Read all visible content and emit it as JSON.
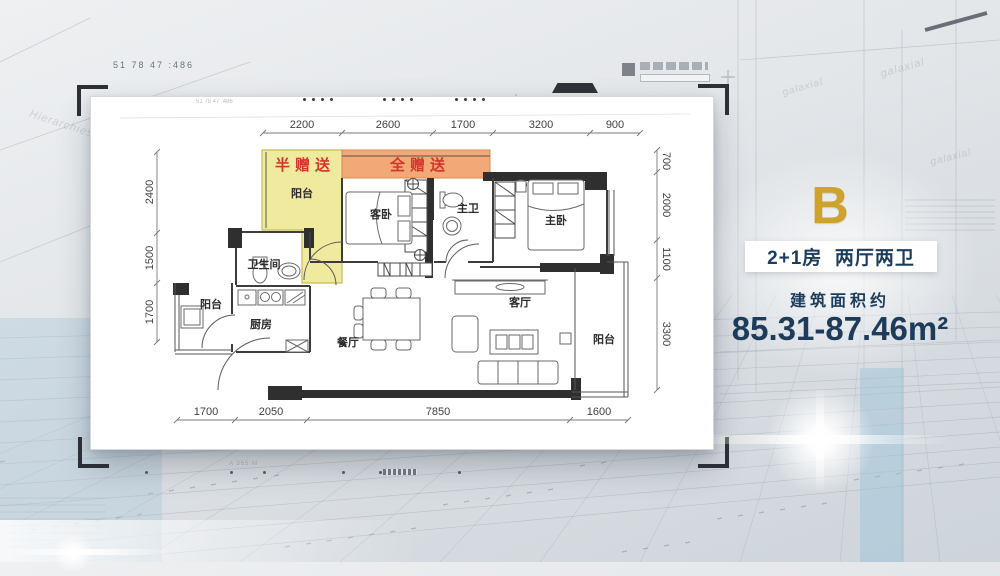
{
  "panel": {
    "block_letter": "B",
    "title": "2+1房  两厅两卫",
    "area_label": "建筑面积约",
    "area_value": "85.31-87.46m²"
  },
  "plan": {
    "gifts": {
      "half": "半赠送",
      "full": "全赠送"
    },
    "rooms": {
      "balcony_top": "阳台",
      "guest_bedroom": "客卧",
      "master_bath": "主卫",
      "master_bedroom": "主卧",
      "bathroom": "卫生间",
      "balcony_left": "阳台",
      "kitchen": "厨房",
      "dining": "餐厅",
      "living": "客厅",
      "balcony_right": "阳台"
    },
    "dims": {
      "top": [
        "2200",
        "2600",
        "1700",
        "3200",
        "900"
      ],
      "left": [
        "2400",
        "1500",
        "1700"
      ],
      "right": [
        "700",
        "2000",
        "1100",
        "3300"
      ],
      "bottom": [
        "1700",
        "2050",
        "7850",
        "1600"
      ]
    }
  },
  "decor": {
    "ruler_text": "51 78 47 :486",
    "bg_word_left": "Hierarchies",
    "bg_word_right": "galaxial",
    "under_card_mark": "A 365 M"
  },
  "colors": {
    "navy": "#1d3c5c",
    "gold": "#cda32b",
    "gift_red": "#d6352b",
    "gift_yellow": "#f0ea9e",
    "gift_orange": "#f2a977",
    "card": "#ffffff"
  }
}
